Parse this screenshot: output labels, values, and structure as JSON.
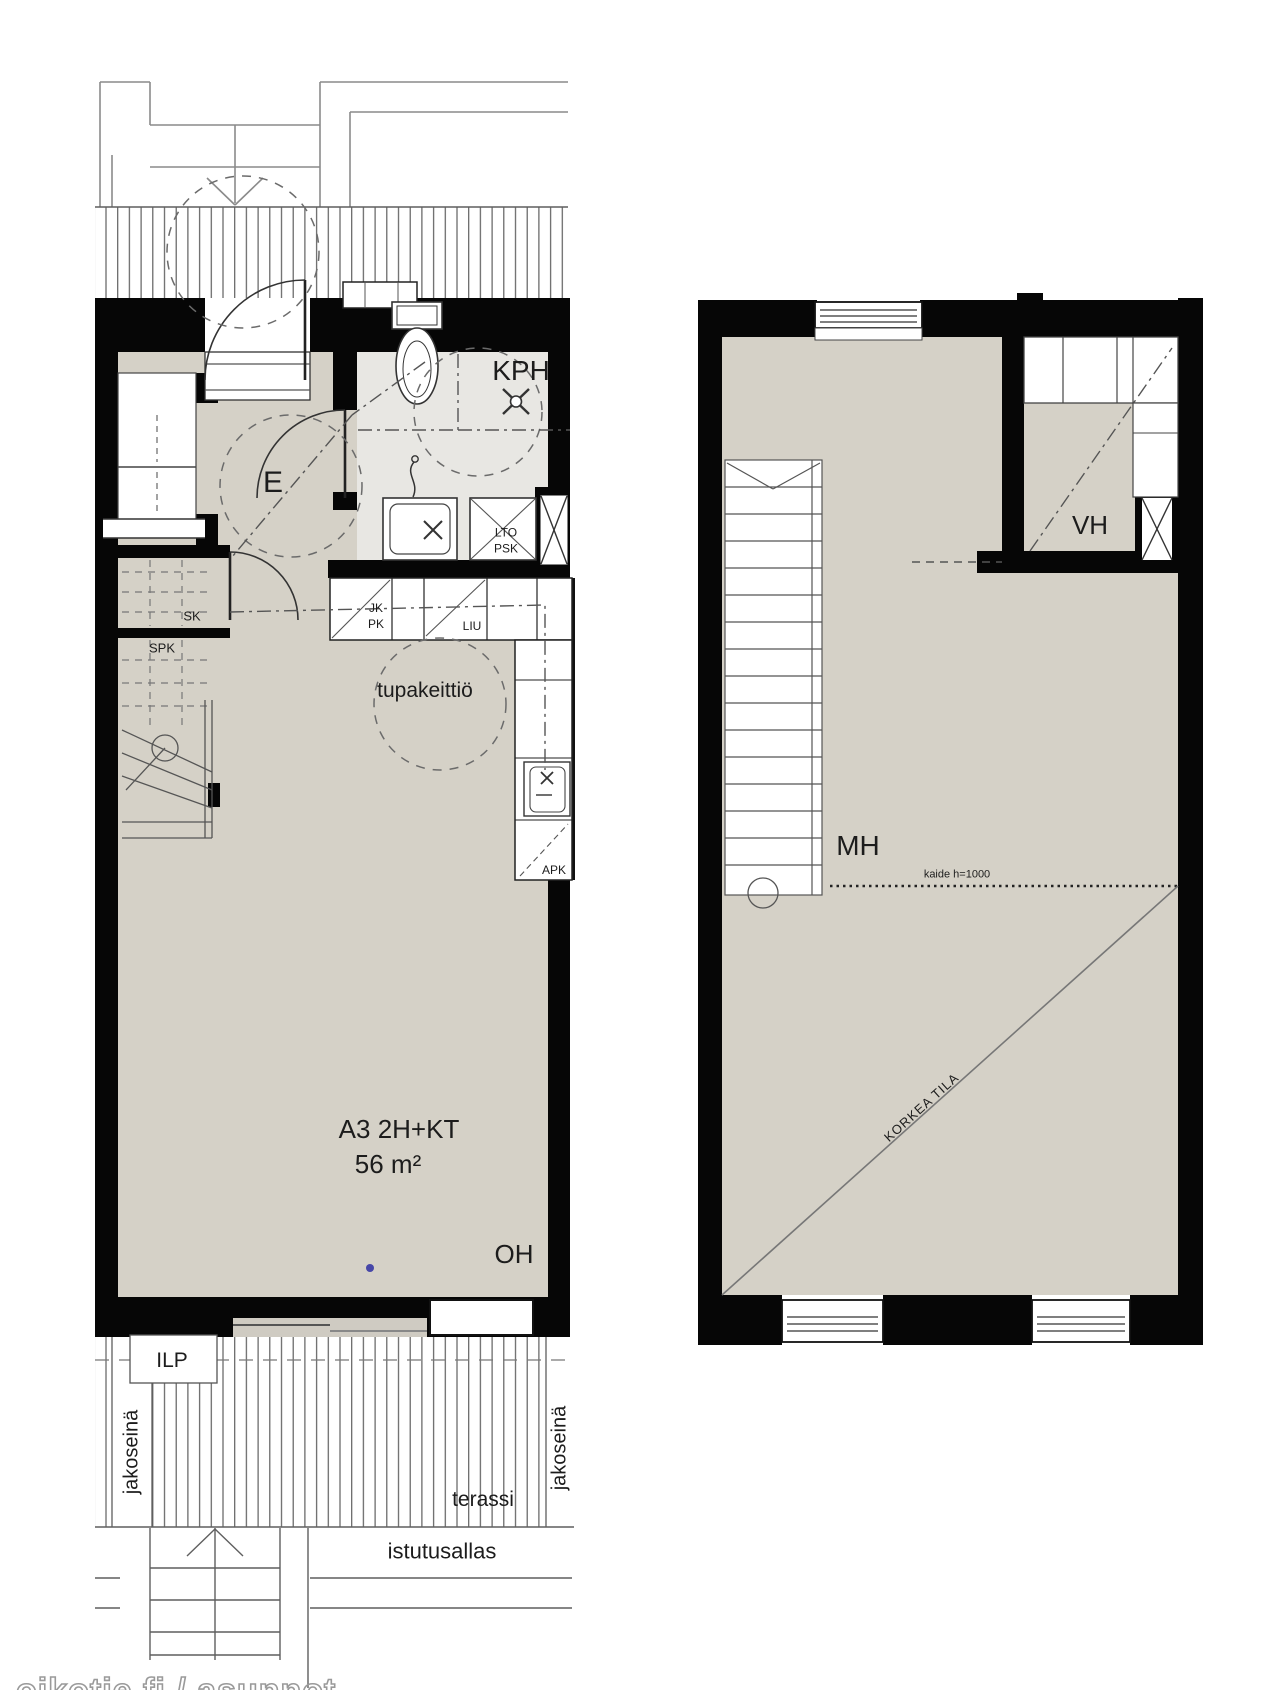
{
  "apartment": {
    "code_label": "A3 2H+KT",
    "area_label": "56 m²"
  },
  "floor1": {
    "labels": {
      "kph": "KPH",
      "e": "E",
      "sk": "SK",
      "spk": "SPK",
      "lto": "LTO",
      "psk": "PSK",
      "jk": "JK",
      "pk": "PK",
      "liu": "LIU",
      "apk": "APK",
      "kitchen": "tupakeittiö",
      "oh": "OH",
      "ilp": "ILP",
      "divider_left": "jakoseinä",
      "divider_right": "jakoseinä",
      "terrace": "terassi",
      "planter": "istutusallas"
    }
  },
  "floor2": {
    "labels": {
      "vh": "VH",
      "mh": "MH",
      "railing": "kaide h=1000",
      "open_space": "KORKEA TILA"
    }
  },
  "watermark": "oikotie.fi / asunnot",
  "colors": {
    "wall": "#060606",
    "floor": "#d5d1c7",
    "wet_floor": "#e8e7e3",
    "hatch_line": "#5f5f5f",
    "marker_blue": "#4747a8"
  }
}
